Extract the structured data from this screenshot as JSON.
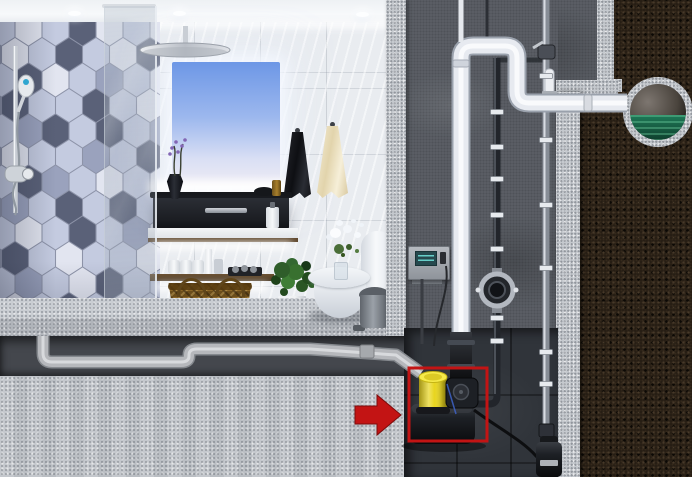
{
  "meta": {
    "type": "3d-cutaway-illustration",
    "description": "Photorealistic cutaway rendering: modern bathroom (hexagon-tile shower wall, glass partition, mirror with sky reflection, dark vanity, shelves, wicker basket, towels, plant, toilet, pedal bin) above a basement utility chase. A compact sewage lifting station with a yellow motor sits in a niche, highlighted by a red outline box and a red arrow. White discharge piping rises up a concrete wall and exits through soil into a buried round sewer main holding green water. A wall control panel, check valve, clamped pipes and a small submersible pump are also shown.",
    "visible_text": "none"
  },
  "annotation": {
    "target": "sewage-lifting-station",
    "shape": "rectangle-outline",
    "pointer": "right-pointing-arrow"
  },
  "colors": {
    "annotation_red": "#c31414",
    "pump_yellow": "#e8d51e",
    "water_green": "#1f7a58",
    "soil_brown": "#241c13",
    "concrete_dark": "#5c6067",
    "granite_light": "#c5c9ce",
    "niche_dark": "#30343a",
    "chase_dark": "#44474d",
    "tile_white": "#e9ecf0",
    "hex_grout": "#8d93a8",
    "pipe_white": "#e7eaf0",
    "pipe_gray": "#b6b8bc",
    "wood_brown": "#5f472c",
    "basket_tan": "#8a6526",
    "screen_teal": "#67cfc9",
    "towel_black": "#1b1d22",
    "towel_cream": "#efe5c6",
    "toilet_white": "#eff2f5"
  },
  "scene": {
    "ceiling_lights": [
      {
        "x": 68,
        "y": 11
      },
      {
        "x": 173,
        "y": 11
      },
      {
        "x": 356,
        "y": 12
      }
    ],
    "hex_wall": {
      "palette": {
        "W": "#e2e5f0",
        "L": "#c4cbe0",
        "M": "#9aa2bd",
        "D": "#5a6178",
        "K": "#454c60"
      },
      "pattern": [
        "L W L D W L W",
        "W L D L W D L",
        "L D W L M L W",
        "D L L D L W L",
        "L M D L D L M",
        "W L L M L D L",
        "L D M L W L W",
        "M L D L D L L",
        "L W L D L M W",
        "D L W L L W L",
        "L M L W D L L",
        "W L D L W L W"
      ]
    },
    "pipe_clamps": {
      "black_pipe": {
        "x": 497,
        "ys": [
          112,
          147,
          179,
          215,
          249,
          318,
          341
        ]
      },
      "chrome_pipe": {
        "x": 546,
        "ys": [
          76,
          140,
          205,
          268,
          352,
          384
        ]
      }
    },
    "objects": [
      "rain-shower-head",
      "hand-shower",
      "shower-mixer",
      "shower-column",
      "hex-tile-wall",
      "glass-partition",
      "mirror",
      "vanity-cabinet",
      "cabinet-handle",
      "flower-vase",
      "floating-shelf",
      "wood-shelf",
      "towel-rolls",
      "wicker-basket",
      "black-towel",
      "cream-towel",
      "potted-plant",
      "toilet",
      "toilet-flowers",
      "pedal-trash-can",
      "bathroom-floor",
      "drain-pipe",
      "foundation-slab",
      "control-panel",
      "discharge-pipe",
      "vent-pipe",
      "check-valve",
      "pipe-clamps",
      "shutoff-valve",
      "cleanout-stub",
      "sewage-lifting-station",
      "pump-motor-yellow",
      "power-cable",
      "submersible-pump",
      "sewer-main-pipe",
      "sewer-water",
      "soil-cross-section",
      "highlight-box",
      "pointer-arrow"
    ]
  }
}
